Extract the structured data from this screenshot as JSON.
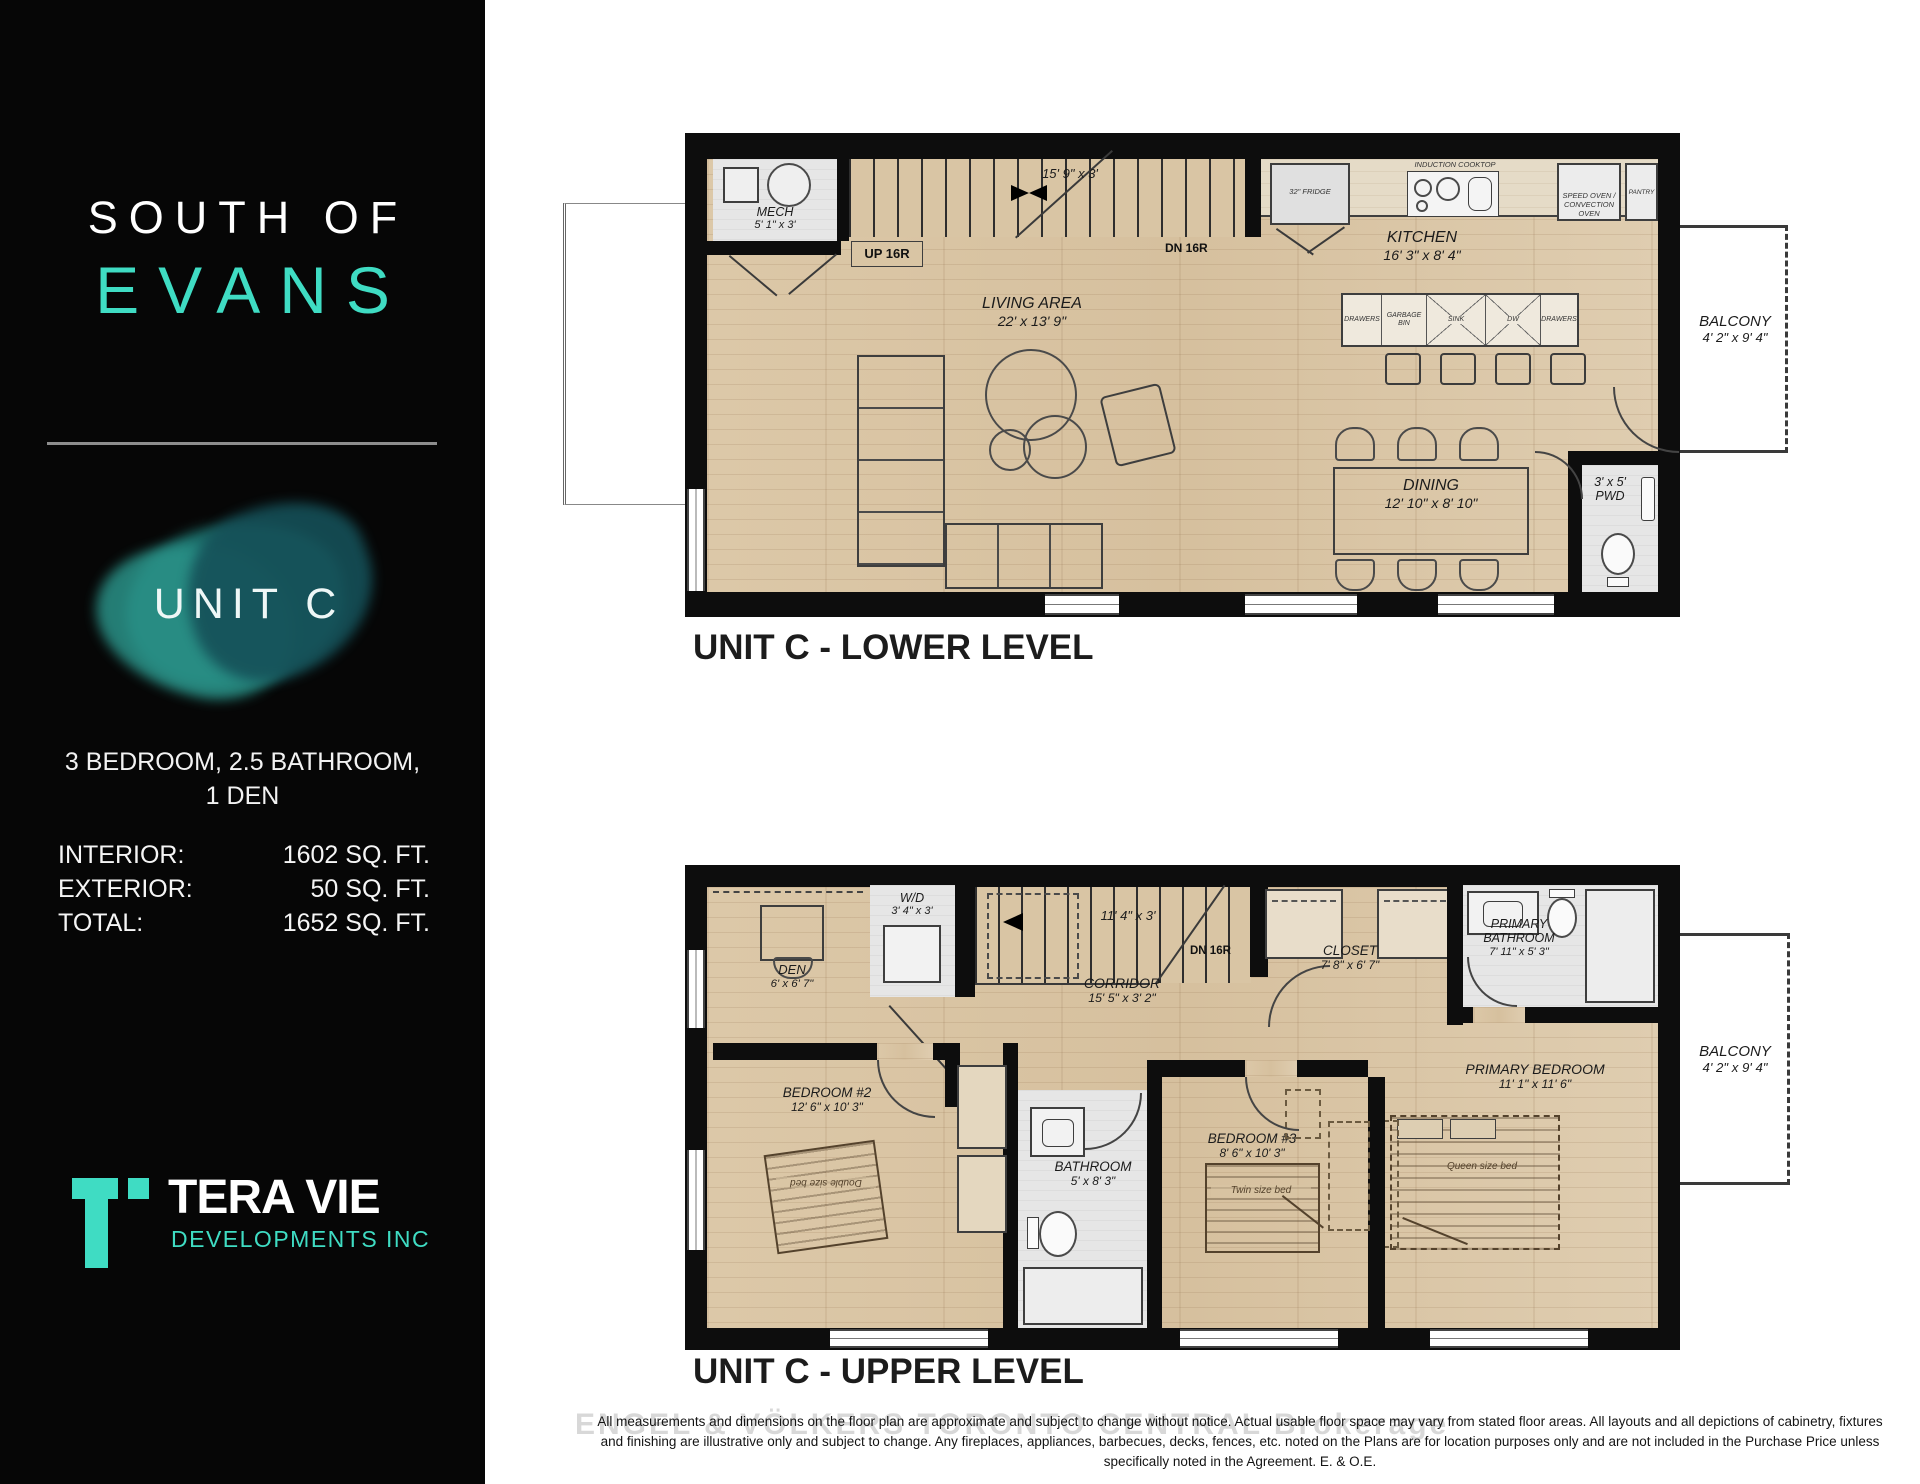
{
  "colors": {
    "accent": "#3fdcc3",
    "wood": "#d9c5a4",
    "wall": "#0d0d0d"
  },
  "sidebar": {
    "title_line1": "SOUTH OF",
    "title_line2": "EVANS",
    "unit_badge": "UNIT C",
    "summary_line1": "3 BEDROOM, 2.5 BATHROOM,",
    "summary_line2": "1 DEN",
    "stats": [
      {
        "label": "INTERIOR:",
        "value": "1602 SQ. FT."
      },
      {
        "label": "EXTERIOR:",
        "value": "50 SQ. FT."
      },
      {
        "label": "TOTAL:",
        "value": "1652 SQ. FT."
      }
    ],
    "logo_name": "TERA VIE",
    "logo_sub": "DEVELOPMENTS INC"
  },
  "lower": {
    "caption": "UNIT C - LOWER LEVEL",
    "mech": {
      "name": "MECH",
      "dims": "5' 1\" x 3'"
    },
    "stair_dim": "15' 9\" x 3'",
    "up": "UP 16R",
    "dn": "DN 16R",
    "fridge": "32\" FRIDGE",
    "cooktop": "INDUCTION COOKTOP",
    "speed_oven_1": "SPEED OVEN /",
    "speed_oven_2": "CONVECTION OVEN",
    "pantry": "PANTRY",
    "kitchen": {
      "name": "KITCHEN",
      "dims": "16' 3\" x 8' 4\""
    },
    "living": {
      "name": "LIVING AREA",
      "dims": "22' x 13' 9\""
    },
    "island": [
      "DRAWERS",
      "GARBAGE BIN",
      "SINK",
      "DW",
      "DRAWERS"
    ],
    "dining": {
      "name": "DINING",
      "dims": "12' 10\" x 8' 10\""
    },
    "pwd": {
      "name": "PWD",
      "dims": "3' x 5'"
    },
    "balcony": {
      "name": "BALCONY",
      "dims": "4' 2\" x 9' 4\""
    }
  },
  "upper": {
    "caption": "UNIT C - UPPER LEVEL",
    "wd": {
      "name": "W/D",
      "dims": "3' 4\" x 3'"
    },
    "den": {
      "name": "DEN",
      "dims": "6' x 6' 7\""
    },
    "stair_dim": "11' 4\" x 3'",
    "dn": "DN 16R",
    "corridor": {
      "name": "CORRIDOR",
      "dims": "15' 5\" x 3' 2\""
    },
    "closet": {
      "name": "CLOSET",
      "dims": "7' 8\" x 6' 7\""
    },
    "primary_bath": {
      "name": "PRIMARY BATHROOM",
      "dims": "7' 11\" x 5' 3\""
    },
    "bedroom2": {
      "name": "BEDROOM #2",
      "dims": "12' 6\" x 10' 3\""
    },
    "bathroom": {
      "name": "BATHROOM",
      "dims": "5' x 8' 3\""
    },
    "bedroom3": {
      "name": "BEDROOM #3",
      "dims": "8' 6\" x 10' 3\""
    },
    "primary_bedroom": {
      "name": "PRIMARY BEDROOM",
      "dims": "11' 1\" x 11' 6\""
    },
    "balcony": {
      "name": "BALCONY",
      "dims": "4' 2\" x 9' 4\""
    },
    "bed_double": "Double size bed",
    "bed_twin": "Twin size bed",
    "bed_queen": "Queen size bed"
  },
  "footer": {
    "watermark": "ENGEL & VÖLKERS TORONTO CENTRAL Brokerage",
    "disclaimer_line1": "All measurements and dimensions on the floor plan are approximate and subject to change without notice. Actual usable floor space may vary from stated floor areas. All layouts and all depictions of cabinetry, fixtures",
    "disclaimer_line2": "and finishing are illustrative only and subject to change. Any fireplaces, appliances, barbecues, decks, fences, etc. noted on the Plans are for location purposes only and are not included in the Purchase Price unless",
    "disclaimer_line3": "specifically noted in the Agreement. E. & O.E."
  }
}
